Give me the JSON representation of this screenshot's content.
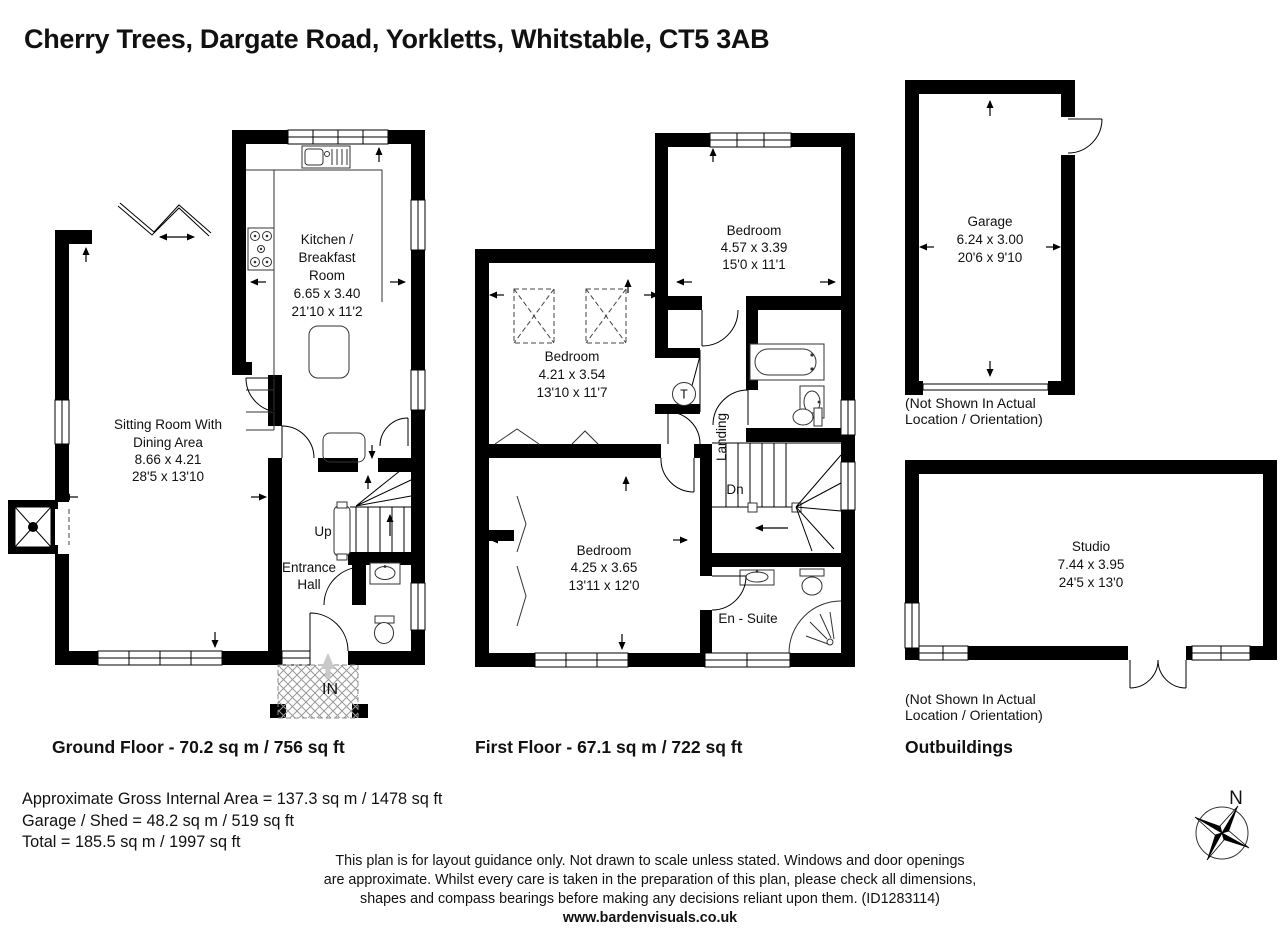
{
  "title": "Cherry Trees, Dargate Road, Yorkletts, Whitstable, CT5 3AB",
  "ground_floor": {
    "label": "Ground Floor - 70.2 sq m / 756 sq ft",
    "kitchen": {
      "name1": "Kitchen /",
      "name2": "Breakfast",
      "name3": "Room",
      "metric": "6.65 x 3.40",
      "imperial": "21'10 x 11'2"
    },
    "sitting_room": {
      "name1": "Sitting Room With",
      "name2": "Dining Area",
      "metric": "8.66 x 4.21",
      "imperial": "28'5 x 13'10"
    },
    "entrance_hall": {
      "name1": "Entrance",
      "name2": "Hall"
    },
    "stairs_label": "Up",
    "entry_label": "IN"
  },
  "first_floor": {
    "label": "First Floor - 67.1 sq m / 722 sq ft",
    "bedroom1": {
      "name": "Bedroom",
      "metric": "4.57 x 3.39",
      "imperial": "15'0 x 11'1"
    },
    "bedroom2": {
      "name": "Bedroom",
      "metric": "4.21 x 3.54",
      "imperial": "13'10 x 11'7"
    },
    "bedroom3": {
      "name": "Bedroom",
      "metric": "4.25 x 3.65",
      "imperial": "13'11 x 12'0"
    },
    "landing_label": "Landing",
    "stairs_label": "Dn",
    "ensuite_label": "En - Suite",
    "tank_label": "T"
  },
  "outbuildings": {
    "label": "Outbuildings",
    "garage": {
      "name": "Garage",
      "metric": "6.24 x 3.00",
      "imperial": "20'6 x 9'10"
    },
    "studio": {
      "name": "Studio",
      "metric": "7.44 x 3.95",
      "imperial": "24'5 x 13'0"
    },
    "note1": "(Not Shown In Actual",
    "note2": "Location / Orientation)"
  },
  "summary": {
    "line1": "Approximate Gross Internal Area = 137.3 sq m / 1478 sq ft",
    "line2": "Garage / Shed = 48.2 sq m / 519 sq ft",
    "line3": "Total = 185.5 sq m / 1997 sq ft"
  },
  "disclaimer": {
    "line1": "This plan is for layout guidance only. Not drawn to scale unless stated. Windows and door openings",
    "line2": "are approximate. Whilst every care is taken in the preparation of this plan, please check all dimensions,",
    "line3": "shapes and compass bearings before making any decisions reliant upon them. (ID1283114)",
    "website": "www.bardenvisuals.co.uk"
  },
  "compass": {
    "north_label": "N"
  }
}
